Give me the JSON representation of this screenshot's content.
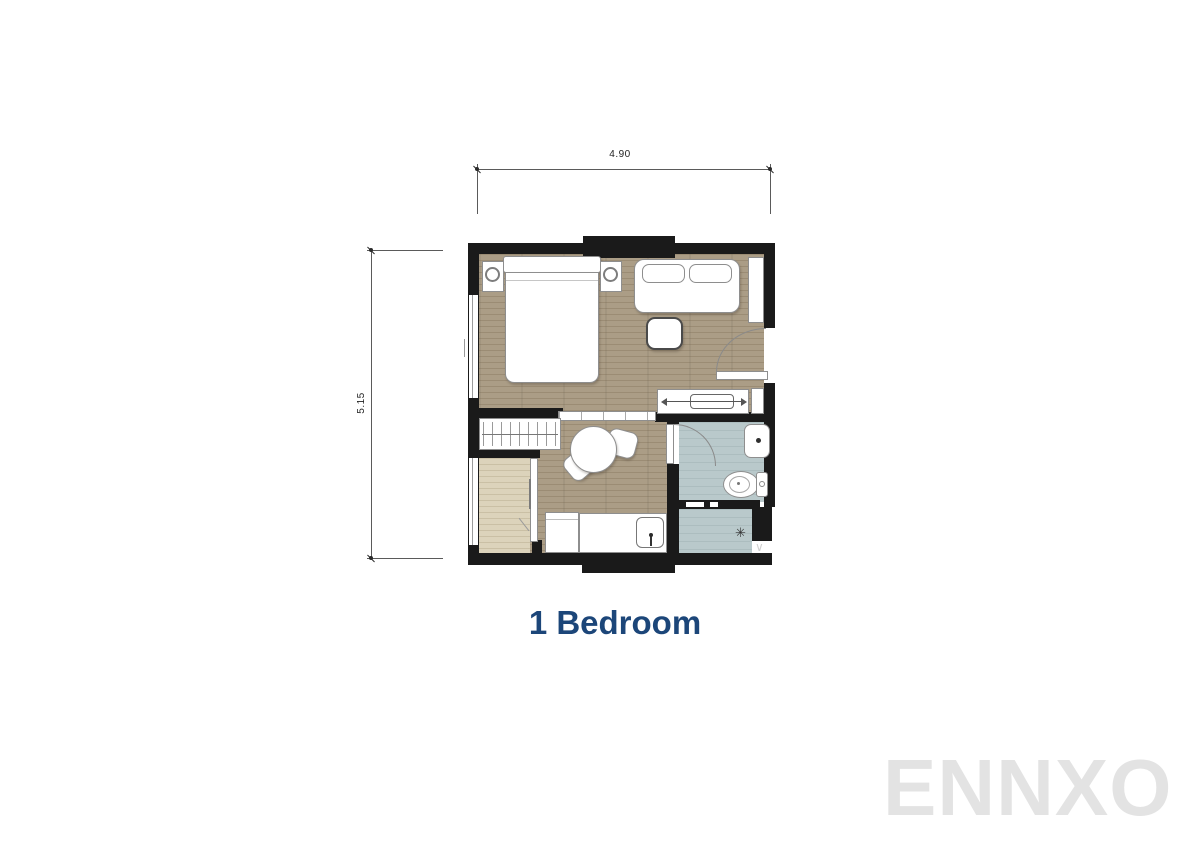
{
  "floor_plan": {
    "title": "1 Bedroom",
    "watermark": "ENNXO",
    "dim_width": "4.90",
    "dim_height": "5.15",
    "shower_symbol": "✳",
    "corner_mark": "∨",
    "colors": {
      "title_text": "#1c4679",
      "watermark_text": "#e3e3e3",
      "wall": "#1a1a1a",
      "wood_floor": "#ab9d86",
      "balcony_floor": "#dcd3bb",
      "bathroom_floor": "#b9c9cb",
      "furniture": "#ffffff"
    }
  }
}
